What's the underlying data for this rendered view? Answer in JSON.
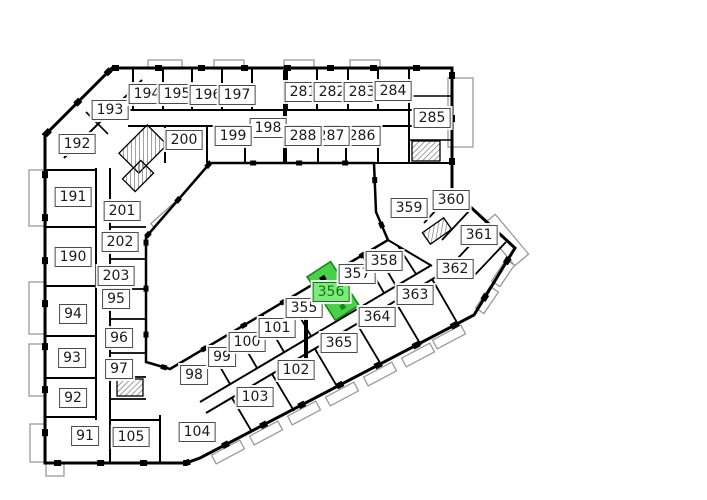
{
  "floor_plan": {
    "selected_room": "356",
    "colors": {
      "wall": "#000000",
      "background": "#ffffff",
      "balcony_outline": "#9a9a9a",
      "label_bg": "#ffffff",
      "label_border": "#4a4a4a",
      "label_text": "#1a1a1a",
      "highlight_room_fill": "#49d149",
      "highlight_room_border": "#0f8a0f",
      "highlight_label_bg": "#7ee87e",
      "highlight_label_text": "#0a7c0a"
    },
    "rooms": [
      {
        "number": "91",
        "x": 85,
        "y": 436
      },
      {
        "number": "92",
        "x": 73,
        "y": 398
      },
      {
        "number": "93",
        "x": 72,
        "y": 358
      },
      {
        "number": "94",
        "x": 73,
        "y": 314
      },
      {
        "number": "95",
        "x": 116,
        "y": 299
      },
      {
        "number": "96",
        "x": 119,
        "y": 338
      },
      {
        "number": "97",
        "x": 119,
        "y": 369
      },
      {
        "number": "98",
        "x": 194,
        "y": 375
      },
      {
        "number": "99",
        "x": 222,
        "y": 357
      },
      {
        "number": "100",
        "x": 247,
        "y": 342
      },
      {
        "number": "101",
        "x": 277,
        "y": 328
      },
      {
        "number": "102",
        "x": 296,
        "y": 370
      },
      {
        "number": "103",
        "x": 255,
        "y": 397
      },
      {
        "number": "104",
        "x": 197,
        "y": 432
      },
      {
        "number": "105",
        "x": 131,
        "y": 437
      },
      {
        "number": "190",
        "x": 73,
        "y": 257
      },
      {
        "number": "191",
        "x": 73,
        "y": 197
      },
      {
        "number": "192",
        "x": 77,
        "y": 144
      },
      {
        "number": "193",
        "x": 110,
        "y": 110
      },
      {
        "number": "194",
        "x": 147,
        "y": 94
      },
      {
        "number": "195",
        "x": 177,
        "y": 94
      },
      {
        "number": "196",
        "x": 208,
        "y": 95
      },
      {
        "number": "197",
        "x": 237,
        "y": 95
      },
      {
        "number": "198",
        "x": 268,
        "y": 128
      },
      {
        "number": "199",
        "x": 233,
        "y": 136
      },
      {
        "number": "200",
        "x": 184,
        "y": 140
      },
      {
        "number": "201",
        "x": 122,
        "y": 211
      },
      {
        "number": "202",
        "x": 120,
        "y": 242
      },
      {
        "number": "203",
        "x": 116,
        "y": 276
      },
      {
        "number": "281",
        "x": 303,
        "y": 92
      },
      {
        "number": "282",
        "x": 332,
        "y": 92
      },
      {
        "number": "283",
        "x": 362,
        "y": 92
      },
      {
        "number": "284",
        "x": 393,
        "y": 91
      },
      {
        "number": "285",
        "x": 432,
        "y": 118
      },
      {
        "number": "286",
        "x": 362,
        "y": 136
      },
      {
        "number": "287",
        "x": 331,
        "y": 136
      },
      {
        "number": "288",
        "x": 303,
        "y": 136
      },
      {
        "number": "355",
        "x": 304,
        "y": 308
      },
      {
        "number": "356",
        "x": 331,
        "y": 292
      },
      {
        "number": "357",
        "x": 357,
        "y": 274
      },
      {
        "number": "358",
        "x": 384,
        "y": 261
      },
      {
        "number": "359",
        "x": 409,
        "y": 208
      },
      {
        "number": "360",
        "x": 451,
        "y": 200
      },
      {
        "number": "361",
        "x": 479,
        "y": 235
      },
      {
        "number": "362",
        "x": 455,
        "y": 269
      },
      {
        "number": "363",
        "x": 415,
        "y": 295
      },
      {
        "number": "364",
        "x": 377,
        "y": 317
      },
      {
        "number": "365",
        "x": 339,
        "y": 343
      }
    ]
  }
}
